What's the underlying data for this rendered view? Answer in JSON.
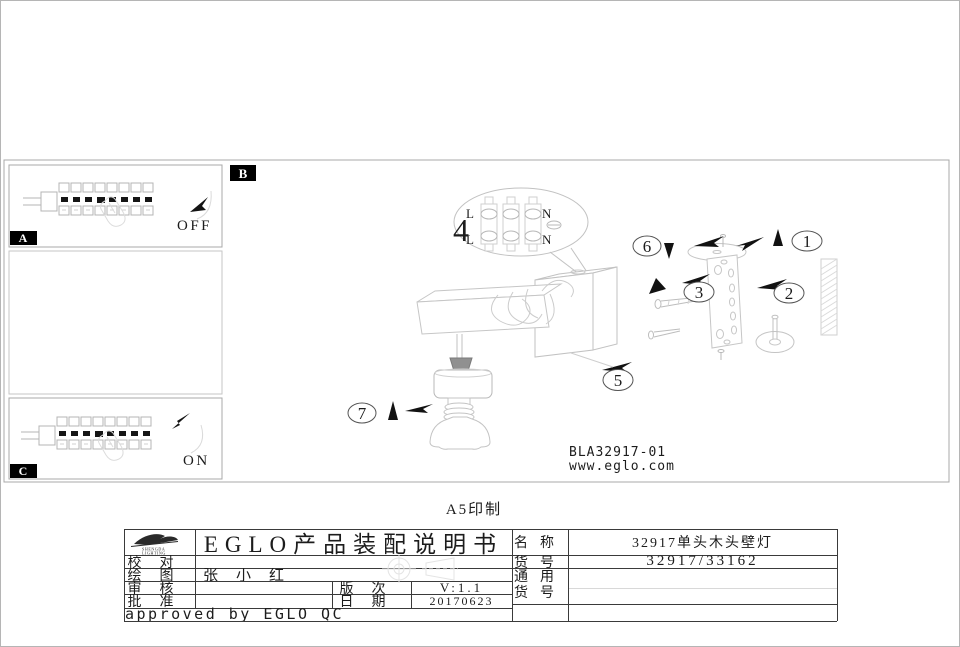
{
  "page": {
    "print_note": "A5印制"
  },
  "colors": {
    "ink": "#1c1c1c",
    "sketch_line": "#c4c4c4",
    "label_bg": "#000000"
  },
  "panel_a": {
    "label": "A",
    "switch_state": "OFF"
  },
  "panel_b": {
    "label": "B"
  },
  "panel_c": {
    "label": "C",
    "switch_state": "ON"
  },
  "diagram": {
    "part_numbers": {
      "n1": "1",
      "n2": "2",
      "n3": "3",
      "n4": "4",
      "n5": "5",
      "n6": "6",
      "n7": "7"
    },
    "terminals": {
      "l_top": "L",
      "l_bottom": "L",
      "n_top": "N",
      "n_bottom": "N"
    },
    "model_code": "BLA32917-01",
    "website": "www.eglo.com"
  },
  "title_block": {
    "logo_line1": "SHENGDA",
    "logo_line2": "LIGHTING",
    "title": "EGLO产品装配说明书",
    "proofread_label": "校对",
    "drawing_label": "绘图",
    "drawn_by": "张小红",
    "review_label": "审核",
    "approve_label": "批准",
    "version_label": "版次",
    "version_value": "V:1.1",
    "date_label": "日期",
    "date_value": "20170623",
    "name_label": "名称",
    "name_value": "32917单头木头壁灯",
    "item_no_label": "货号",
    "item_no_value": "32917/33162",
    "universal_label_line1": "通用",
    "universal_label_line2": "货号",
    "universal_value": "",
    "approved_note": "approved by EGLO QC"
  }
}
